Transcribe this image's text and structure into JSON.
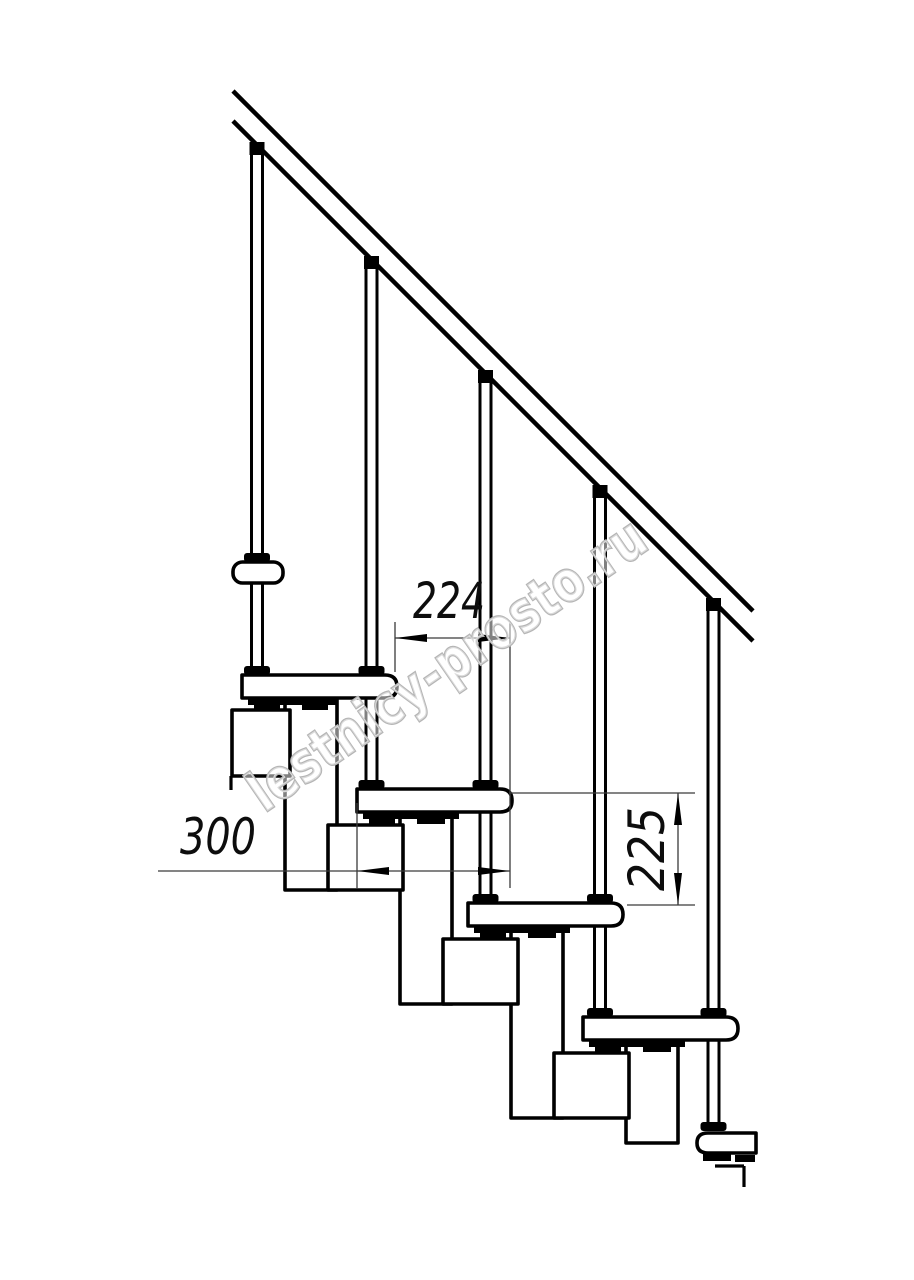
{
  "drawing": {
    "title": "Staircase side elevation",
    "watermark": {
      "text": "lestnicy-prosto.ru"
    },
    "dimensions": {
      "step_run": "224",
      "step_depth": "300",
      "step_rise": "225"
    },
    "colors": {
      "line": "#000000",
      "dim_line": "#3a3a3a",
      "text": "#0d0d0d",
      "watermark": "#b5b5b5",
      "background": "#ffffff"
    }
  }
}
